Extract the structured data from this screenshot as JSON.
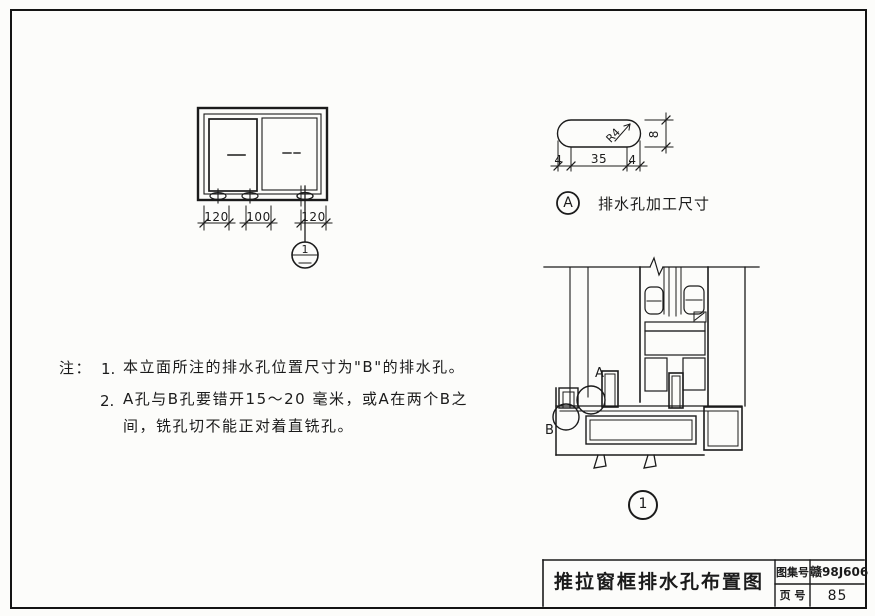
{
  "elevation": {
    "dims": [
      "120",
      "100",
      "120"
    ],
    "callout_number": "1"
  },
  "detail_a": {
    "dim_left": "4",
    "dim_mid": "35",
    "dim_right": "4",
    "dim_height": "8",
    "radius_label": "R4",
    "bubble_letter": "A",
    "caption": "排水孔加工尺寸"
  },
  "section": {
    "label_a": "A",
    "label_b": "B",
    "callout_number": "1"
  },
  "notes": {
    "prefix": "注：",
    "item1_no": "1.",
    "item1": "本立面所注的排水孔位置尺寸为\"B\"的排水孔。",
    "item2_no": "2.",
    "item2_line1": "A孔与B孔要错开15～20 毫米，或A在两个B之",
    "item2_line2": "间，铣孔切不能正对着直铣孔。"
  },
  "title_block": {
    "title": "推拉窗框排水孔布置图",
    "atlas_label": "图集号",
    "atlas_value": "赣98J606",
    "page_label": "页 号",
    "page_value": "85"
  }
}
